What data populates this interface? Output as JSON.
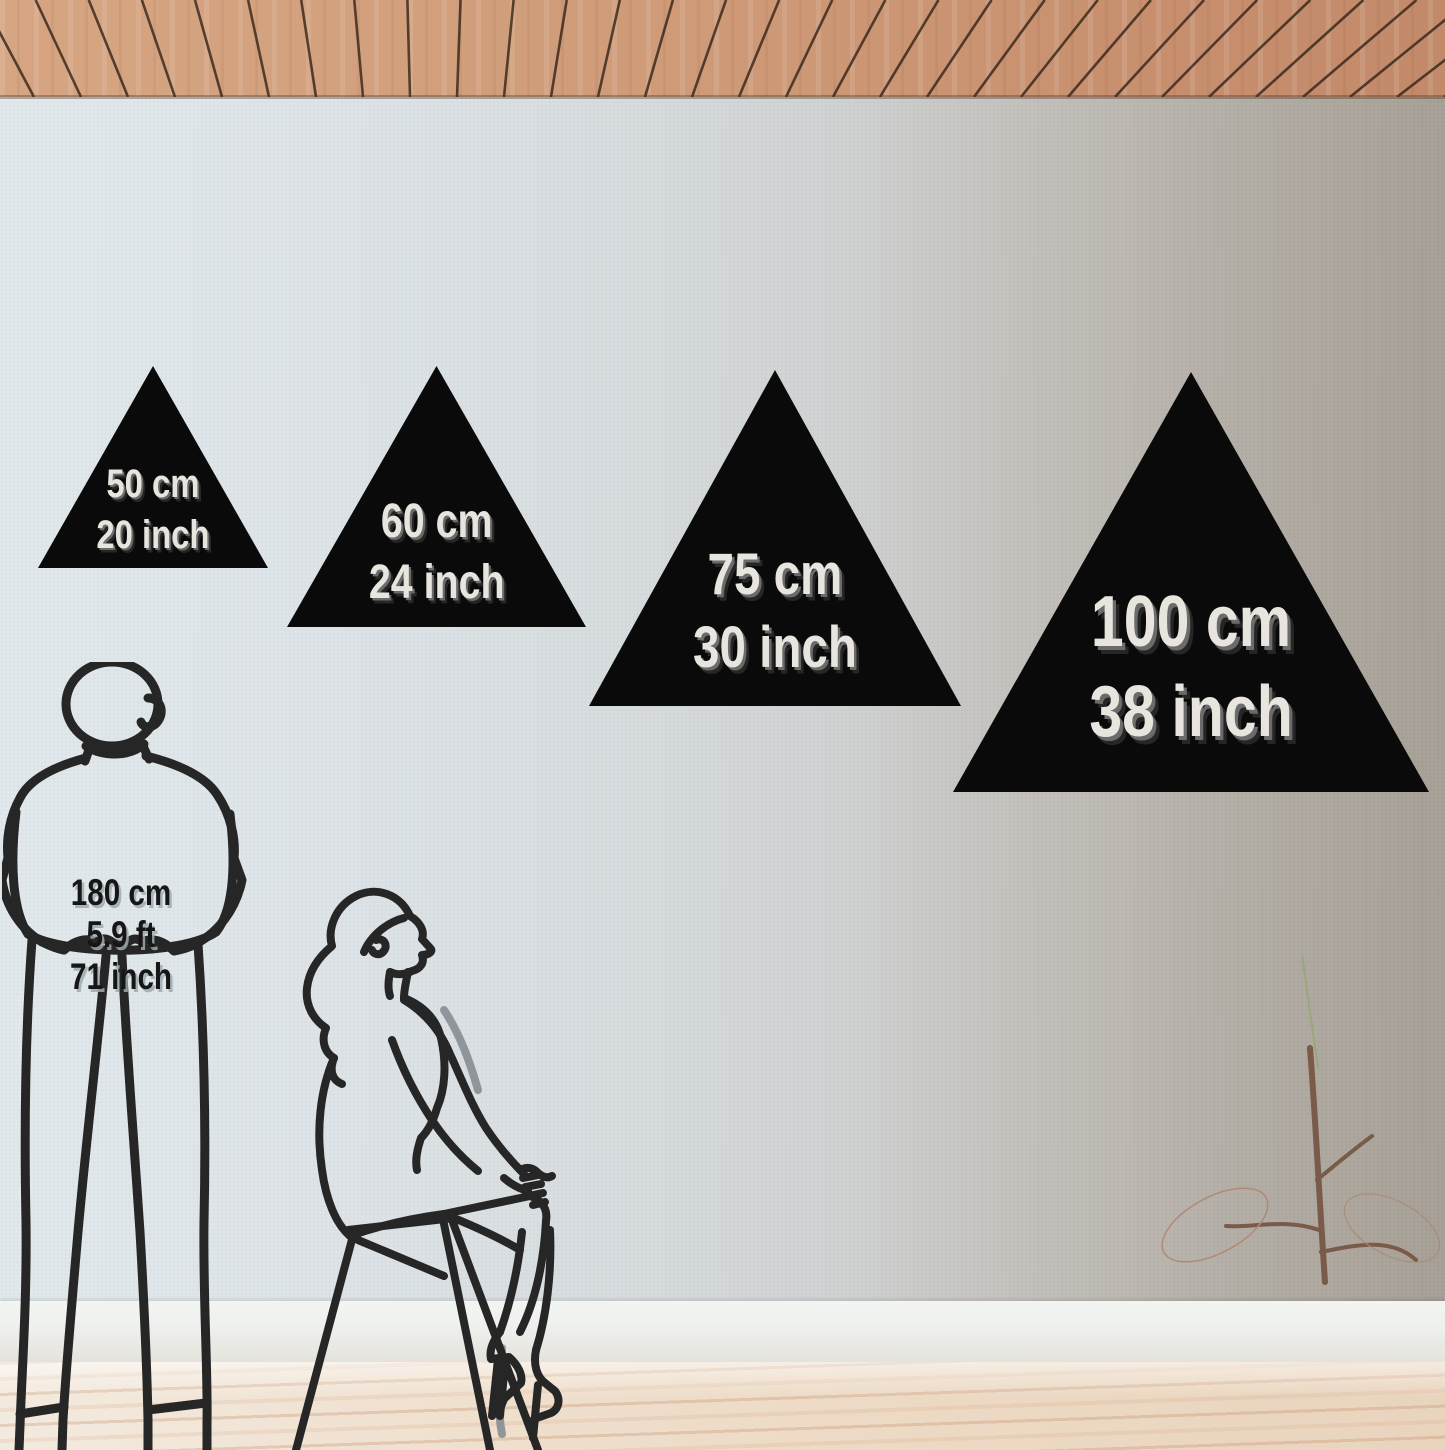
{
  "triangles": [
    {
      "cm": "50 cm",
      "inch": "20 inch"
    },
    {
      "cm": "60 cm",
      "inch": "24 inch"
    },
    {
      "cm": "75 cm",
      "inch": "30 inch"
    },
    {
      "cm": "100 cm",
      "inch": "38 inch"
    }
  ],
  "figure_standing": {
    "lines": [
      "180 cm",
      "5.9 ft",
      "71 inch"
    ]
  },
  "colors": {
    "triangle_black": "#0a0a0a",
    "triangle_label": "#e7e5de",
    "triangle_label_shadow": "#5c5c5c",
    "height_label": "#161616",
    "line_art": "#262626",
    "ceiling_wood": "#cd9a79",
    "wall_left": "#dfe7ea",
    "wall_right": "#aaa49b",
    "baseboard": "#eff1ef",
    "floor": "#eedcc9"
  }
}
